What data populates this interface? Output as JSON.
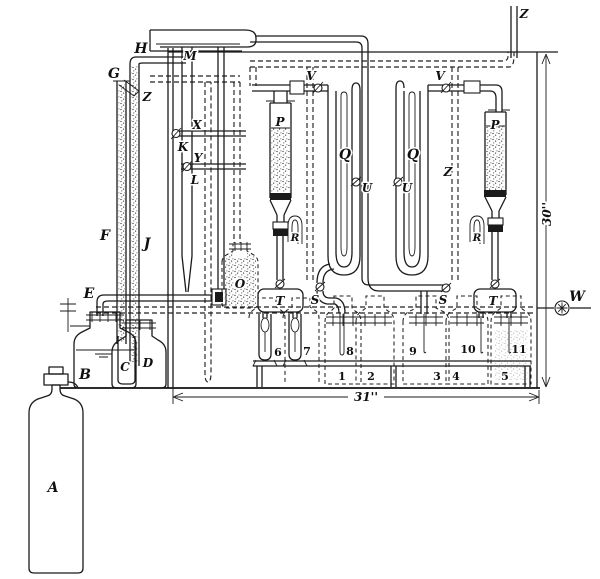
{
  "diagram": {
    "figure_type": "gas-train-apparatus",
    "dimensions": {
      "height": "30''",
      "width": "31''"
    },
    "parts": {
      "gas_cylinder": "A",
      "wash_bottle": "B",
      "inner_vessel": "C",
      "leveling_bottle": "D",
      "inlet_bend": "E",
      "gauge_tube_left": "F",
      "vent_opening": "G",
      "header_tube": "H",
      "gauge_tube_right": "J",
      "stopcock_k": "K",
      "stopcock_l": "L",
      "manifold": "M",
      "reagent_bottle": "O",
      "tower_left": "P",
      "tower_right": "P",
      "utube_left": "Q",
      "utube_right": "Q",
      "trap_left": "R",
      "trap_right": "R",
      "stopcock_s_left": "S",
      "stopcock_s_right": "S",
      "delivery_head_left": "T",
      "delivery_head_right": "T",
      "stopcock_u_left": "U",
      "stopcock_u_right": "U",
      "stopcock_v_left": "V",
      "stopcock_v_right": "V",
      "outlet_valve": "W",
      "branch_upper": "X",
      "branch_lower": "Y",
      "vent_jet": "Z",
      "vent_line": "Z",
      "exhaust_tube": "Z"
    },
    "flask_numbers": [
      "1",
      "2",
      "3",
      "4",
      "5"
    ],
    "tube_numbers": [
      "6",
      "7",
      "8",
      "9",
      "10",
      "11"
    ]
  }
}
